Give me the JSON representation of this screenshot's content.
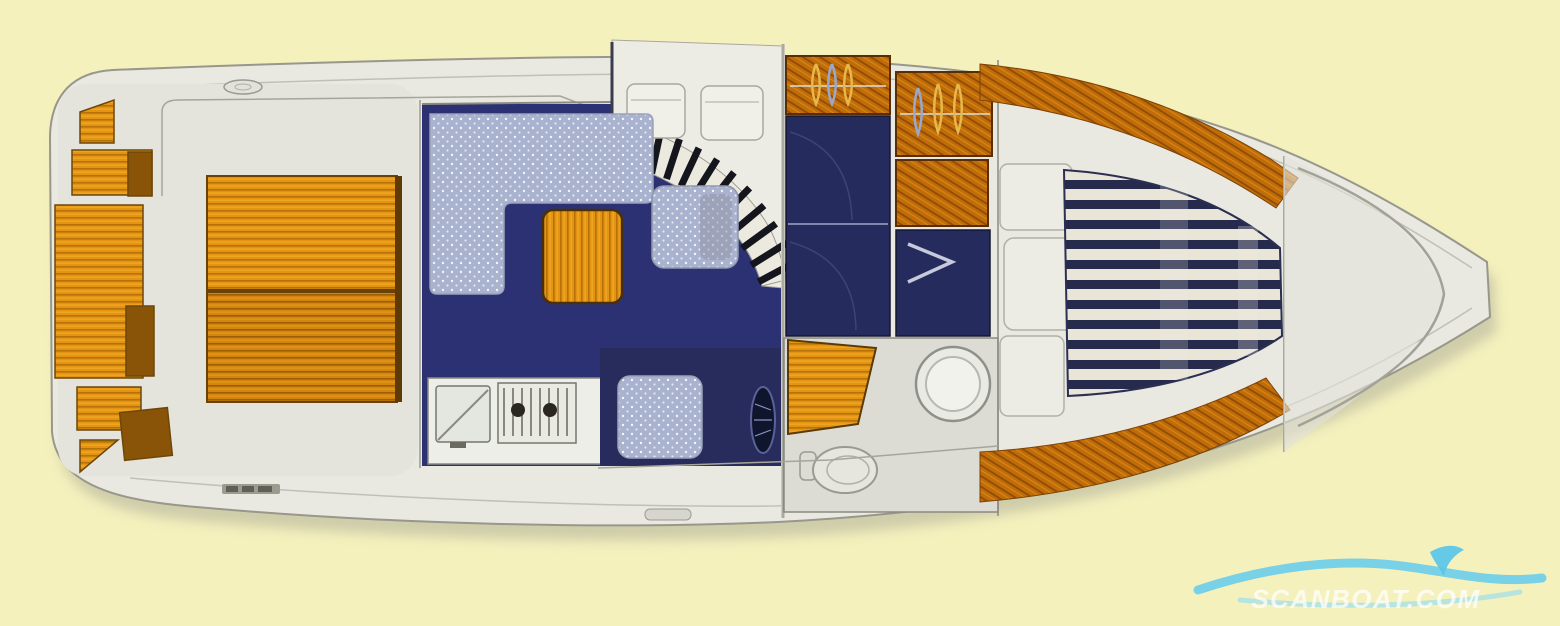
{
  "artwork": {
    "type": "boat-interior-layout-plan",
    "view": "top-down",
    "orientation": "stern-left-bow-right"
  },
  "watermark": {
    "text": "SCANBOAT.COM",
    "wave_color": "#5fc9ee",
    "fin_color": "#57c4ea",
    "text_color": "#ffffff"
  },
  "palette": {
    "background": "#f5f1bd",
    "hull": "#e9e9e2",
    "hull_outline": "#97978c",
    "shadow": "#a9a897",
    "teak": "#e49410",
    "teak_slat": "#b5720a",
    "wardrobe_wood": "#c06c09",
    "salon_floor_navy": "#2c3173",
    "berth_navy": "#262b5e",
    "upholstery_speckled_blue": "#a9b2ce",
    "mattress_navy": "#262b4e",
    "mattress_white": "#e9e6d8",
    "stair_tread_dark": "#15151d",
    "counter_white": "#edeee8"
  },
  "regions": [
    {
      "name": "aft-cockpit-seating"
    },
    {
      "name": "cockpit-teak-deck"
    },
    {
      "name": "companionway-stairs"
    },
    {
      "name": "salon-sofa"
    },
    {
      "name": "salon-table"
    },
    {
      "name": "salon-armchair"
    },
    {
      "name": "galley-sink"
    },
    {
      "name": "galley-stove"
    },
    {
      "name": "helm-seat"
    },
    {
      "name": "steering-wheel"
    },
    {
      "name": "wardrobe-port"
    },
    {
      "name": "wardrobe-starboard"
    },
    {
      "name": "mid-cabin-berth"
    },
    {
      "name": "head-vanity"
    },
    {
      "name": "head-sink"
    },
    {
      "name": "toilet"
    },
    {
      "name": "forward-v-berth"
    },
    {
      "name": "anchor-locker"
    }
  ]
}
